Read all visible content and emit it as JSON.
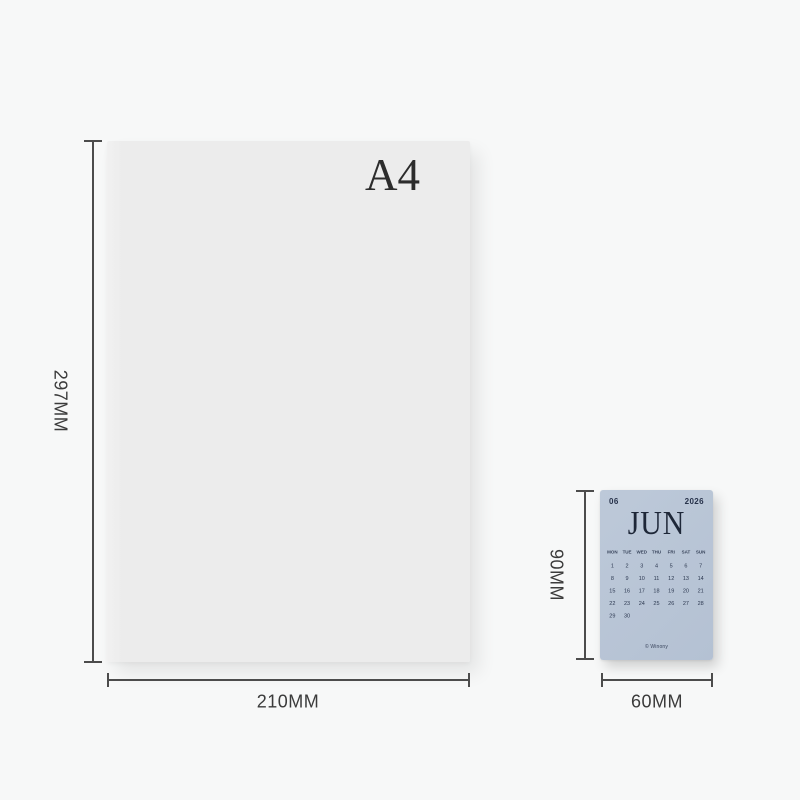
{
  "page": {
    "background_color": "#f7f8f8"
  },
  "a4_sheet": {
    "title": "A4",
    "height_label": "297MM",
    "width_label": "210MM",
    "color": "#ececec"
  },
  "calendar_card": {
    "height_label": "90MM",
    "width_label": "60MM",
    "month_number": "06",
    "year": "2026",
    "month_name": "JUN",
    "weekdays": [
      "MON",
      "TUE",
      "WED",
      "THU",
      "FRI",
      "SAT",
      "SUN"
    ],
    "weeks": [
      [
        "1",
        "2",
        "3",
        "4",
        "5",
        "6",
        "7"
      ],
      [
        "8",
        "9",
        "10",
        "11",
        "12",
        "13",
        "14"
      ],
      [
        "15",
        "16",
        "17",
        "18",
        "19",
        "20",
        "21"
      ],
      [
        "22",
        "23",
        "24",
        "25",
        "26",
        "27",
        "28"
      ],
      [
        "29",
        "30",
        "",
        "",
        "",
        "",
        ""
      ]
    ],
    "footer_logo": "© Winony",
    "card_color": "#b8c5d6",
    "text_color": "#232e45"
  }
}
